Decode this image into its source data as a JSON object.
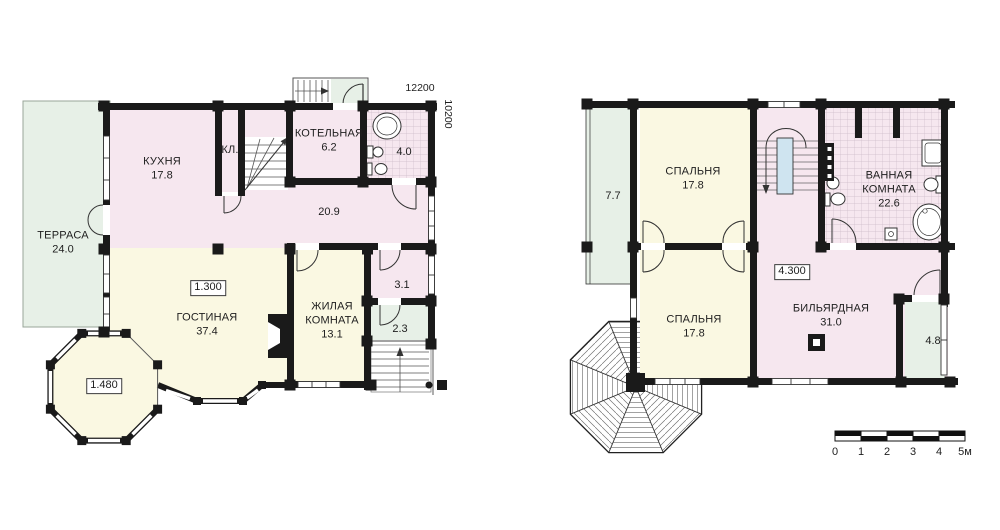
{
  "plan_first_floor": {
    "rooms": {
      "terrace": {
        "name": "ТЕРРАСА",
        "area": "24.0"
      },
      "kitchen": {
        "name": "КУХНЯ",
        "area": "17.8"
      },
      "closet": {
        "name": "КЛ."
      },
      "boiler": {
        "name": "КОТЕЛЬНАЯ",
        "area": "6.2"
      },
      "bath": {
        "area": "4.0"
      },
      "hall": {
        "area": "20.9"
      },
      "living": {
        "name": "ГОСТИНАЯ",
        "area": "37.4"
      },
      "bedroom": {
        "name": "ЖИЛАЯ КОМНАТА",
        "area": "13.1"
      },
      "lobby": {
        "area": "3.1"
      },
      "entry": {
        "area": "2.3"
      }
    },
    "elevation_marks": {
      "living": "1.300",
      "bay": "1.480"
    },
    "dimensions": {
      "width": "12200",
      "depth": "10200"
    }
  },
  "plan_second_floor": {
    "rooms": {
      "balcony": {
        "area": "7.7"
      },
      "bedroom_top": {
        "name": "СПАЛЬНЯ",
        "area": "17.8"
      },
      "bathroom": {
        "name": "ВАННАЯ КОМНАТА",
        "area": "22.6"
      },
      "bedroom_bottom": {
        "name": "СПАЛЬНЯ",
        "area": "17.8"
      },
      "billiard": {
        "name": "БИЛЬЯРДНАЯ",
        "area": "31.0"
      },
      "balcony_small": {
        "area": "4.8"
      }
    },
    "elevation_marks": {
      "level": "4.300"
    }
  },
  "scale_bar": {
    "labels": [
      "0",
      "1",
      "2",
      "3",
      "4",
      "5м"
    ]
  },
  "colors": {
    "room_pink": "#f6e7ef",
    "room_cream": "#faf8e2",
    "outdoor_green": "#e7f0e7",
    "stair_well_blue": "#cfe4f0",
    "wall": "#1a1a1a"
  }
}
